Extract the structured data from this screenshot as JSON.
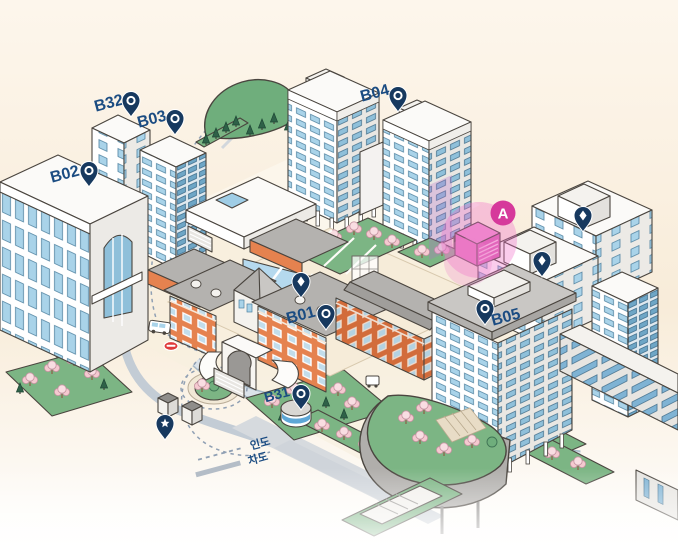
{
  "map": {
    "legend": {
      "items": [
        {
          "id": "pedestrian",
          "label": "인도",
          "line_style": "dashed"
        },
        {
          "id": "roadway",
          "label": "차도",
          "line_style": "solid"
        }
      ]
    },
    "buildings": {
      "b01": {
        "label": "B01"
      },
      "b02": {
        "label": "B02"
      },
      "b03": {
        "label": "B03"
      },
      "b04": {
        "label": "B04"
      },
      "b05": {
        "label": "B05"
      },
      "b31": {
        "label": "B31"
      },
      "b32": {
        "label": "B32"
      }
    },
    "highlight": {
      "label": "A"
    },
    "icons": {
      "pin_ring": "location-pin-ring-icon",
      "pin_diamond": "location-pin-diamond-icon",
      "pin_star": "location-pin-star-icon"
    },
    "colors": {
      "background": "#f9edda",
      "pin_navy": "#17395f",
      "label_navy": "#1b4c82",
      "highlight_magenta": "#d6399b",
      "highlight_glow": "#f06ec8",
      "brick": "#e5824f",
      "window_blue": "#a9d3e9",
      "greenery": "#6fae7c",
      "blossom_pink": "#f5c9d0",
      "road": "#c3ccd5",
      "blue_roof": "#b5d9ee",
      "bus_stop_red": "#e03a3a"
    }
  }
}
